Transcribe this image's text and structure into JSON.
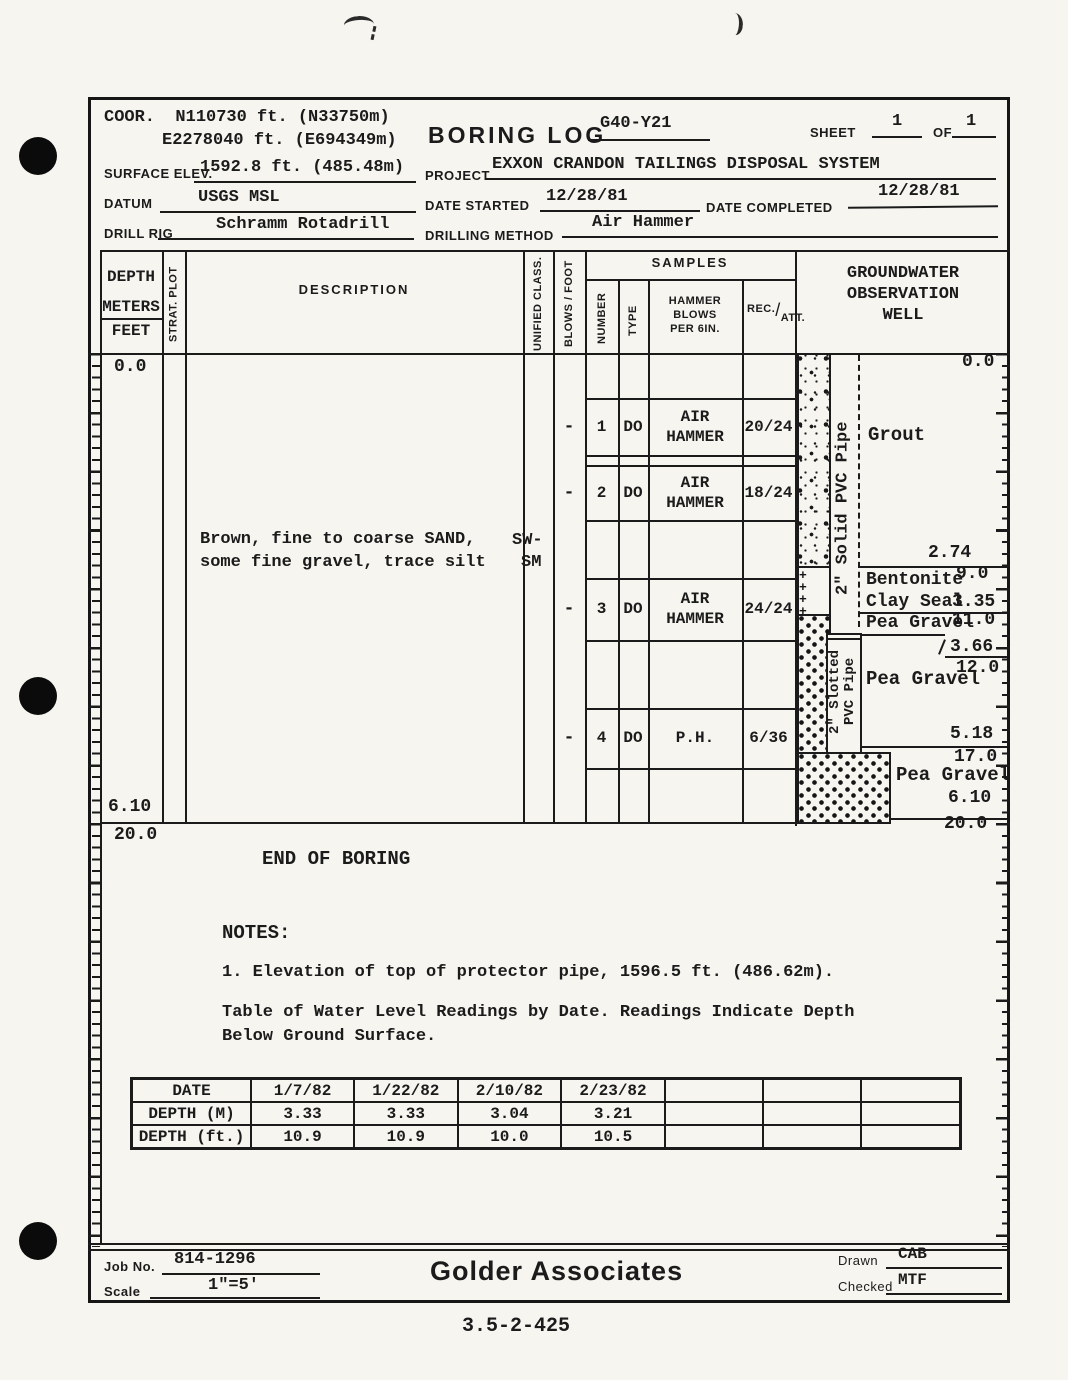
{
  "header": {
    "coor_label": "COOR.",
    "coor_north": "N110730 ft. (N33750m)",
    "coor_east": "E2278040 ft. (E694349m)",
    "title": "BORING LOG",
    "boring_id": "G40-Y21",
    "sheet_label": "SHEET",
    "sheet_no": "1",
    "of_label": "OF",
    "sheet_total": "1",
    "surface_elev_label": "SURFACE ELEV.",
    "surface_elev": "1592.8 ft. (485.48m)",
    "project_label": "PROJECT",
    "project": "EXXON CRANDON TAILINGS DISPOSAL SYSTEM",
    "datum_label": "DATUM",
    "datum": "USGS MSL",
    "date_started_label": "DATE STARTED",
    "date_started": "12/28/81",
    "date_completed_label": "DATE COMPLETED",
    "date_completed": "12/28/81",
    "drill_rig_label": "DRILL RIG",
    "drill_rig": "Schramm Rotadrill",
    "drilling_method_label": "DRILLING METHOD",
    "drilling_method": "Air Hammer"
  },
  "log": {
    "columns": {
      "depth": "DEPTH",
      "meters": "METERS",
      "feet": "FEET",
      "strat_plot": "STRAT. PLOT",
      "description": "DESCRIPTION",
      "unified_class": "UNIFIED CLASS.",
      "blows_foot": "BLOWS / FOOT",
      "samples": "SAMPLES",
      "number": "NUMBER",
      "type": "TYPE",
      "hammer_1": "HAMMER",
      "hammer_2": "BLOWS",
      "hammer_3": "PER 6IN.",
      "rec": "REC.",
      "slash": "/",
      "att": "ATT.",
      "well_1": "GROUNDWATER",
      "well_2": "OBSERVATION",
      "well_3": "WELL"
    },
    "depth_left_top": "0.0",
    "depth_left_bottom_m": "6.10",
    "depth_left_bottom_ft": "20.0",
    "description_line1": "Brown, fine to coarse SAND,",
    "description_line2": "some fine gravel, trace silt",
    "unified_line1": "SW-",
    "unified_line2": "SM",
    "samples": [
      {
        "blows": "-",
        "number": "1",
        "type": "DO",
        "hammer": "AIR HAMMER",
        "rec": "20/24"
      },
      {
        "blows": "-",
        "number": "2",
        "type": "DO",
        "hammer": "AIR HAMMER",
        "rec": "18/24"
      },
      {
        "blows": "-",
        "number": "3",
        "type": "DO",
        "hammer": "AIR HAMMER",
        "rec": "24/24"
      },
      {
        "blows": "-",
        "number": "4",
        "type": "DO",
        "hammer": "P.H.",
        "rec": "6/36"
      }
    ],
    "well": {
      "top_mark": "0.0",
      "solid_pipe_label": "2\" Solid PVC Pipe",
      "slotted_pipe_label": "2\" Slotted PVC Pipe",
      "grout_label": "Grout",
      "grout_m": "2.74",
      "grout_ft": "9.0",
      "bentonite_line1": "Bentonite",
      "bentonite_line2": "Clay Seal",
      "bentonite_m": "3.35",
      "pea1_label": "Pea Gravel",
      "pea1_ft": "11.0",
      "pea1_m": "3.66",
      "pea1_ft2": "12.0",
      "pea2_label": "Pea Gravel",
      "pea2_m": "5.18",
      "pea2_ft": "17.0",
      "pea3_label": "Pea Gravel",
      "pea3_m": "6.10",
      "pea3_ft": "20.0"
    }
  },
  "notes": {
    "end_of_boring": "END OF BORING",
    "notes_label": "NOTES:",
    "note1": "1.  Elevation of top of protector pipe, 1596.5 ft. (486.62m).",
    "caption_line1": "Table of Water Level Readings by Date.  Readings Indicate Depth",
    "caption_line2": "Below Ground Surface."
  },
  "water_table": {
    "rows": [
      {
        "label": "DATE",
        "values": [
          "1/7/82",
          "1/22/82",
          "2/10/82",
          "2/23/82",
          "",
          "",
          ""
        ]
      },
      {
        "label": "DEPTH (M)",
        "values": [
          "3.33",
          "3.33",
          "3.04",
          "3.21",
          "",
          "",
          ""
        ]
      },
      {
        "label": "DEPTH (ft.)",
        "values": [
          "10.9",
          "10.9",
          "10.0",
          "10.5",
          "",
          "",
          ""
        ]
      }
    ]
  },
  "footer": {
    "job_no_label": "Job No.",
    "job_no": "814-1296",
    "scale_label": "Scale",
    "scale": "1\"=5'",
    "company": "Golder  Associates",
    "drawn_label": "Drawn",
    "drawn": "CAB",
    "checked_label": "Checked",
    "checked": "MTF"
  },
  "page": {
    "doc_number": "3.5-2-425"
  }
}
